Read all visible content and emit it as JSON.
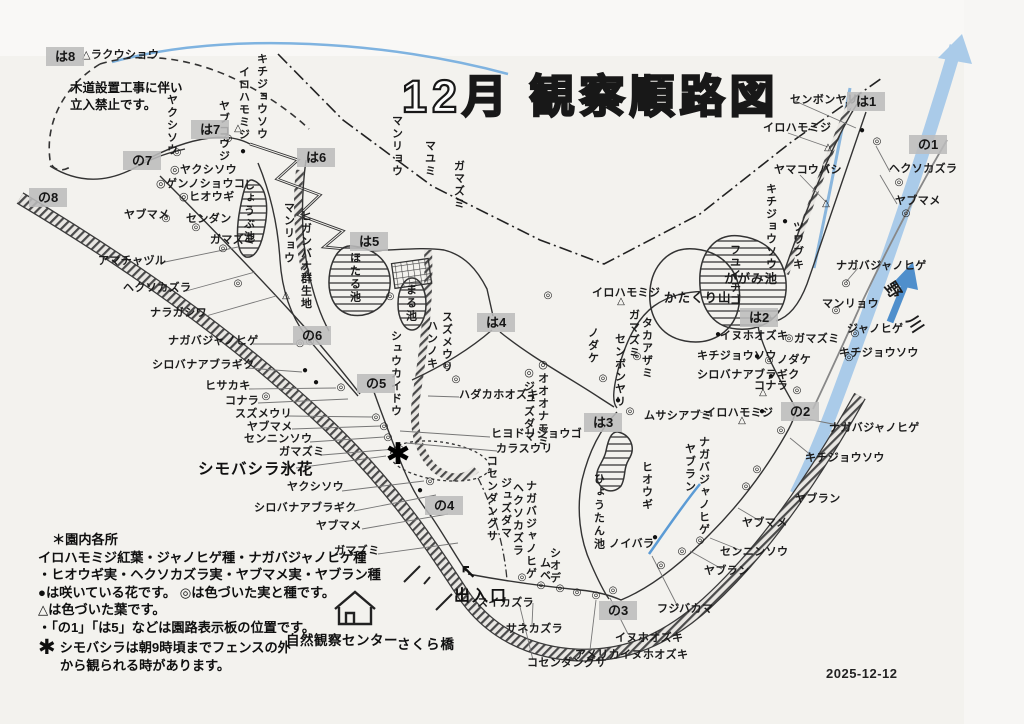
{
  "title": "12月 観察順路図",
  "date": "2025-12-12",
  "notice": {
    "line1": "木道設置工事に伴い",
    "line2": "立入禁止です。"
  },
  "legend": {
    "heading": "＊園内各所",
    "lines": [
      "イロハモミジ紅葉・ジャノヒゲ種・ナガバジャノヒゲ種",
      "・ヒオウギ実・ヘクソカズラ実・ヤブマメ実・ヤブラン種",
      "●は咲いている花です。 ◎は色づいた実と種です。",
      "△は色づいた葉です。",
      "・「の1」「は5」などは園路表示板の位置です。"
    ],
    "frost_mark": "✱",
    "frost_note1": "シモバシラは朝9時頃までフェンスの外",
    "frost_note2": "から観られる時があります。"
  },
  "facilities": {
    "nature_center": "自然観察センター",
    "bridge": "さくら橋",
    "entrance": "出入口",
    "entrance_arrow": "↖",
    "river": "野 川",
    "frost_flower": "シモバシラ氷花",
    "frost_mark": "✱"
  },
  "signs": [
    {
      "label": "は8",
      "x": 46,
      "y": 47
    },
    {
      "label": "は7",
      "x": 191,
      "y": 120
    },
    {
      "label": "は6",
      "x": 297,
      "y": 148
    },
    {
      "label": "は5",
      "x": 350,
      "y": 232
    },
    {
      "label": "は4",
      "x": 477,
      "y": 313
    },
    {
      "label": "は3",
      "x": 584,
      "y": 413
    },
    {
      "label": "は2",
      "x": 740,
      "y": 308
    },
    {
      "label": "は1",
      "x": 847,
      "y": 92
    },
    {
      "label": "の8",
      "x": 29,
      "y": 188
    },
    {
      "label": "の7",
      "x": 123,
      "y": 151
    },
    {
      "label": "の6",
      "x": 293,
      "y": 326
    },
    {
      "label": "の5",
      "x": 357,
      "y": 374
    },
    {
      "label": "の4",
      "x": 425,
      "y": 496
    },
    {
      "label": "の3",
      "x": 599,
      "y": 601
    },
    {
      "label": "の2",
      "x": 781,
      "y": 402
    },
    {
      "label": "の1",
      "x": 909,
      "y": 135
    }
  ],
  "labels": [
    {
      "t": "△ラクウショウ",
      "x": 82,
      "y": 50
    },
    {
      "t": "◎ヤクシソウ",
      "x": 170,
      "y": 165
    },
    {
      "t": "◎ゲンノショウコ",
      "x": 156,
      "y": 179
    },
    {
      "t": "◎ヒオウギ",
      "x": 179,
      "y": 192
    },
    {
      "t": "ヤブマメ",
      "x": 124,
      "y": 210
    },
    {
      "t": "センダン",
      "x": 186,
      "y": 214
    },
    {
      "t": "ガマズミ",
      "x": 210,
      "y": 235
    },
    {
      "t": "アマチャヅル",
      "x": 98,
      "y": 256
    },
    {
      "t": "ヘクソカズラ",
      "x": 123,
      "y": 283
    },
    {
      "t": "ナラガシワ",
      "x": 150,
      "y": 308
    },
    {
      "t": "ナガバジャノヒゲ",
      "x": 168,
      "y": 336
    },
    {
      "t": "シロバナアブラギク",
      "x": 152,
      "y": 360
    },
    {
      "t": "ヒサカキ",
      "x": 205,
      "y": 381
    },
    {
      "t": "コナラ",
      "x": 225,
      "y": 396
    },
    {
      "t": "スズメウリ",
      "x": 235,
      "y": 409
    },
    {
      "t": "ヤブマメ",
      "x": 247,
      "y": 422
    },
    {
      "t": "センニンソウ",
      "x": 244,
      "y": 434
    },
    {
      "t": "ガマズミ",
      "x": 279,
      "y": 447
    },
    {
      "t": "ヤクシソウ",
      "x": 287,
      "y": 482
    },
    {
      "t": "シロバナアブラギク",
      "x": 254,
      "y": 503
    },
    {
      "t": "ヤブマメ",
      "x": 316,
      "y": 521
    },
    {
      "t": "ガマズミ",
      "x": 334,
      "y": 546
    },
    {
      "t": "ハダカホオズキ",
      "x": 459,
      "y": 390
    },
    {
      "t": "ヒヨドリジョウゴ",
      "x": 491,
      "y": 429
    },
    {
      "t": "カラスウリ",
      "x": 496,
      "y": 444
    },
    {
      "t": "スイカズラ",
      "x": 477,
      "y": 598
    },
    {
      "t": "サネカズラ",
      "x": 506,
      "y": 624
    },
    {
      "t": "コセンダングサ",
      "x": 527,
      "y": 658
    },
    {
      "t": "アメリカイヌホオズキ",
      "x": 575,
      "y": 650
    },
    {
      "t": "イヌホオズキ",
      "x": 615,
      "y": 633
    },
    {
      "t": "ノイバラ",
      "x": 609,
      "y": 539
    },
    {
      "t": "フジバカマ",
      "x": 657,
      "y": 604
    },
    {
      "t": "ヤブラン",
      "x": 704,
      "y": 566
    },
    {
      "t": "センニンソウ",
      "x": 720,
      "y": 547
    },
    {
      "t": "ヤブマメ",
      "x": 742,
      "y": 518
    },
    {
      "t": "ヤブラン",
      "x": 795,
      "y": 494
    },
    {
      "t": "キチジョウソウ",
      "x": 805,
      "y": 453
    },
    {
      "t": "ナガバジャノヒゲ",
      "x": 829,
      "y": 423
    },
    {
      "t": "ムサシアブミ",
      "x": 644,
      "y": 411
    },
    {
      "t": "イロハモミジ",
      "x": 705,
      "y": 408
    },
    {
      "t": "コナラ",
      "x": 754,
      "y": 381
    },
    {
      "t": "シロバナアブラギク",
      "x": 697,
      "y": 370
    },
    {
      "t": "キチジョウソウ",
      "x": 697,
      "y": 351
    },
    {
      "t": "イヌホオズキ",
      "x": 720,
      "y": 331
    },
    {
      "t": "ガマズミ",
      "x": 794,
      "y": 334
    },
    {
      "t": "ノダケ",
      "x": 777,
      "y": 355
    },
    {
      "t": "マンリョウ",
      "x": 822,
      "y": 299
    },
    {
      "t": "ジャノヒゲ",
      "x": 847,
      "y": 324
    },
    {
      "t": "キチジョウソウ",
      "x": 839,
      "y": 348
    },
    {
      "t": "ナガバジャノヒゲ",
      "x": 836,
      "y": 261
    },
    {
      "t": "かたくり山",
      "x": 664,
      "y": 292,
      "c": "area"
    },
    {
      "t": "かがみ池",
      "x": 724,
      "y": 273,
      "c": "area"
    },
    {
      "t": "イロハモミジ",
      "x": 592,
      "y": 288
    },
    {
      "t": "センボンヤリ",
      "x": 790,
      "y": 95
    },
    {
      "t": "イロハモミジ",
      "x": 763,
      "y": 123
    },
    {
      "t": "ヤマコウバシ",
      "x": 774,
      "y": 165
    },
    {
      "t": "ヘクソカズラ",
      "x": 889,
      "y": 164
    },
    {
      "t": "ヤブマメ",
      "x": 895,
      "y": 196
    },
    {
      "t": "ヤクシソウ",
      "x": 165,
      "y": 94,
      "v": 1
    },
    {
      "t": "ヤブコウジ",
      "x": 217,
      "y": 100,
      "v": 1
    },
    {
      "t": "イロハモミジ",
      "x": 237,
      "y": 66,
      "v": 1
    },
    {
      "t": "キチジョウソウ",
      "x": 255,
      "y": 53,
      "v": 1
    },
    {
      "t": "マンリョウ",
      "x": 282,
      "y": 202,
      "v": 1
    },
    {
      "t": "ヒガンバナ群生地",
      "x": 299,
      "y": 210,
      "v": 1
    },
    {
      "t": "しょうぶ池",
      "x": 242,
      "y": 179,
      "v": 1,
      "c": "pond"
    },
    {
      "t": "マンリョウ",
      "x": 390,
      "y": 115,
      "v": 1
    },
    {
      "t": "マユミ",
      "x": 423,
      "y": 140,
      "v": 1
    },
    {
      "t": "ガマズミ",
      "x": 452,
      "y": 160,
      "v": 1
    },
    {
      "t": "ほたる池",
      "x": 348,
      "y": 252,
      "v": 1,
      "c": "pond"
    },
    {
      "t": "まる池",
      "x": 404,
      "y": 284,
      "v": 1,
      "c": "pond"
    },
    {
      "t": "シュウカイドウ",
      "x": 389,
      "y": 330,
      "v": 1
    },
    {
      "t": "スズメウリ",
      "x": 440,
      "y": 311,
      "v": 1
    },
    {
      "t": "ハンノキ",
      "x": 425,
      "y": 320,
      "v": 1
    },
    {
      "t": "◎オオオナモミ",
      "x": 536,
      "y": 358,
      "v": 1
    },
    {
      "t": "◎ジュズダマ",
      "x": 522,
      "y": 366,
      "v": 1
    },
    {
      "t": "コセンダングサ",
      "x": 485,
      "y": 455,
      "v": 1
    },
    {
      "t": "ジュズダマ",
      "x": 499,
      "y": 477,
      "v": 1
    },
    {
      "t": "ヘクソカズラ",
      "x": 511,
      "y": 482,
      "v": 1
    },
    {
      "t": "ナガバジャノヒゲ",
      "x": 524,
      "y": 480,
      "v": 1
    },
    {
      "t": "シオデ",
      "x": 548,
      "y": 547,
      "v": 1
    },
    {
      "t": "ムベ",
      "x": 538,
      "y": 557,
      "v": 1
    },
    {
      "t": "ひょうたん池",
      "x": 592,
      "y": 473,
      "v": 1,
      "c": "pond"
    },
    {
      "t": "ヒオウギ",
      "x": 640,
      "y": 461,
      "v": 1
    },
    {
      "t": "ヤブラン",
      "x": 683,
      "y": 443,
      "v": 1
    },
    {
      "t": "ナガバジャノヒゲ",
      "x": 697,
      "y": 436,
      "v": 1
    },
    {
      "t": "フユイチゴ",
      "x": 728,
      "y": 244,
      "v": 1
    },
    {
      "t": "キチジョウソウ",
      "x": 764,
      "y": 183,
      "v": 1
    },
    {
      "t": "ツワブキ",
      "x": 791,
      "y": 221,
      "v": 1
    },
    {
      "t": "ガマズミ",
      "x": 627,
      "y": 309,
      "v": 1
    },
    {
      "t": "タカアザミ",
      "x": 640,
      "y": 317,
      "v": 1
    },
    {
      "t": "センボンヤリ",
      "x": 613,
      "y": 333,
      "v": 1
    },
    {
      "t": "ノダケ",
      "x": 586,
      "y": 327,
      "v": 1
    }
  ],
  "markers": [
    {
      "k": "ring",
      "x": 228,
      "y": 139
    },
    {
      "k": "ring",
      "x": 177,
      "y": 153
    },
    {
      "k": "ring",
      "x": 166,
      "y": 219
    },
    {
      "k": "ring",
      "x": 196,
      "y": 228
    },
    {
      "k": "ring",
      "x": 223,
      "y": 249
    },
    {
      "k": "ring",
      "x": 238,
      "y": 284
    },
    {
      "k": "ring",
      "x": 300,
      "y": 344
    },
    {
      "k": "ring",
      "x": 341,
      "y": 388
    },
    {
      "k": "ring",
      "x": 376,
      "y": 418
    },
    {
      "k": "ring",
      "x": 384,
      "y": 427
    },
    {
      "k": "ring",
      "x": 388,
      "y": 438
    },
    {
      "k": "ring",
      "x": 400,
      "y": 450
    },
    {
      "k": "ring",
      "x": 430,
      "y": 482
    },
    {
      "k": "ring",
      "x": 266,
      "y": 397
    },
    {
      "k": "ring",
      "x": 447,
      "y": 366
    },
    {
      "k": "ring",
      "x": 456,
      "y": 380
    },
    {
      "k": "ring",
      "x": 522,
      "y": 578
    },
    {
      "k": "ring",
      "x": 541,
      "y": 586
    },
    {
      "k": "ring",
      "x": 560,
      "y": 589
    },
    {
      "k": "ring",
      "x": 577,
      "y": 593
    },
    {
      "k": "ring",
      "x": 596,
      "y": 596
    },
    {
      "k": "ring",
      "x": 613,
      "y": 591
    },
    {
      "k": "ring",
      "x": 661,
      "y": 566
    },
    {
      "k": "ring",
      "x": 682,
      "y": 552
    },
    {
      "k": "ring",
      "x": 700,
      "y": 541
    },
    {
      "k": "ring",
      "x": 746,
      "y": 487
    },
    {
      "k": "ring",
      "x": 757,
      "y": 470
    },
    {
      "k": "ring",
      "x": 781,
      "y": 431
    },
    {
      "k": "ring",
      "x": 797,
      "y": 391
    },
    {
      "k": "ring",
      "x": 603,
      "y": 379
    },
    {
      "k": "ring",
      "x": 630,
      "y": 412
    },
    {
      "k": "ring",
      "x": 637,
      "y": 357
    },
    {
      "k": "ring",
      "x": 767,
      "y": 318
    },
    {
      "k": "ring",
      "x": 899,
      "y": 183
    },
    {
      "k": "ring",
      "x": 906,
      "y": 214
    },
    {
      "k": "ring",
      "x": 846,
      "y": 284
    },
    {
      "k": "ring",
      "x": 836,
      "y": 311
    },
    {
      "k": "ring",
      "x": 855,
      "y": 334
    },
    {
      "k": "ring",
      "x": 849,
      "y": 358
    },
    {
      "k": "ring",
      "x": 877,
      "y": 142
    },
    {
      "k": "ring",
      "x": 390,
      "y": 297
    },
    {
      "k": "ring",
      "x": 310,
      "y": 342
    },
    {
      "k": "ring",
      "x": 548,
      "y": 296
    },
    {
      "k": "ring",
      "x": 769,
      "y": 361
    },
    {
      "k": "ring",
      "x": 789,
      "y": 339
    },
    {
      "k": "dot",
      "x": 243,
      "y": 152
    },
    {
      "k": "dot",
      "x": 305,
      "y": 371
    },
    {
      "k": "dot",
      "x": 316,
      "y": 383
    },
    {
      "k": "dot",
      "x": 420,
      "y": 491
    },
    {
      "k": "dot",
      "x": 618,
      "y": 401
    },
    {
      "k": "dot",
      "x": 718,
      "y": 335
    },
    {
      "k": "dot",
      "x": 757,
      "y": 357
    },
    {
      "k": "dot",
      "x": 771,
      "y": 377
    },
    {
      "k": "dot",
      "x": 762,
      "y": 412
    },
    {
      "k": "dot",
      "x": 862,
      "y": 131
    },
    {
      "k": "dot",
      "x": 785,
      "y": 222
    },
    {
      "k": "dot",
      "x": 655,
      "y": 538
    },
    {
      "k": "tri",
      "x": 238,
      "y": 129
    },
    {
      "k": "tri",
      "x": 286,
      "y": 296
    },
    {
      "k": "tri",
      "x": 621,
      "y": 302
    },
    {
      "k": "tri",
      "x": 742,
      "y": 421
    },
    {
      "k": "tri",
      "x": 763,
      "y": 393
    },
    {
      "k": "tri",
      "x": 828,
      "y": 148
    },
    {
      "k": "tri",
      "x": 826,
      "y": 204
    },
    {
      "k": "star",
      "x": 398,
      "y": 455
    }
  ],
  "colors": {
    "river": "#aacbe9",
    "river_dark": "#4f8fcc",
    "blue_line": "#7fb3e0",
    "ink": "#222222",
    "sign_bg": "#bcbcbc",
    "paper": "#f3f2ee"
  }
}
